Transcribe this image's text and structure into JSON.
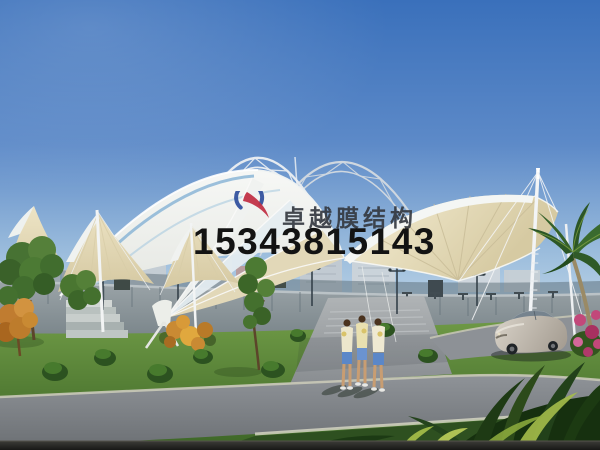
{
  "watermark": {
    "logo": "sail-swoosh-logo",
    "company_name": "卓越膜结构",
    "phone_number": "15343815143"
  },
  "palette": {
    "sky_top": "#3a70bb",
    "sky_horizon": "#c2d7e8",
    "membrane_white": "#f2f4f1",
    "membrane_cream": "#e4daba",
    "truss_steel": "#dfe6ec",
    "grass_green": "#5d8a3a",
    "road_asphalt": "#83878c",
    "wall_grey": "#8a949a",
    "logo_red": "#c13246",
    "logo_blue": "#2e4d9c",
    "company_text_color": "#343840",
    "phone_text_color": "#131313"
  },
  "scene": {
    "subject": "tensile membrane entrance canopy architectural rendering",
    "elements": [
      "blue gradient sky",
      "white lattice truss arches",
      "white membrane dome",
      "cream fabric sails",
      "support masts and cables",
      "city skyline",
      "perimeter wall with gate",
      "street lamps",
      "lawn with shrubs",
      "trees",
      "palm tree",
      "pink flower bush",
      "entrance plaza",
      "asphalt road",
      "three pedestrians",
      "silver sedan car",
      "foreground foliage"
    ]
  }
}
